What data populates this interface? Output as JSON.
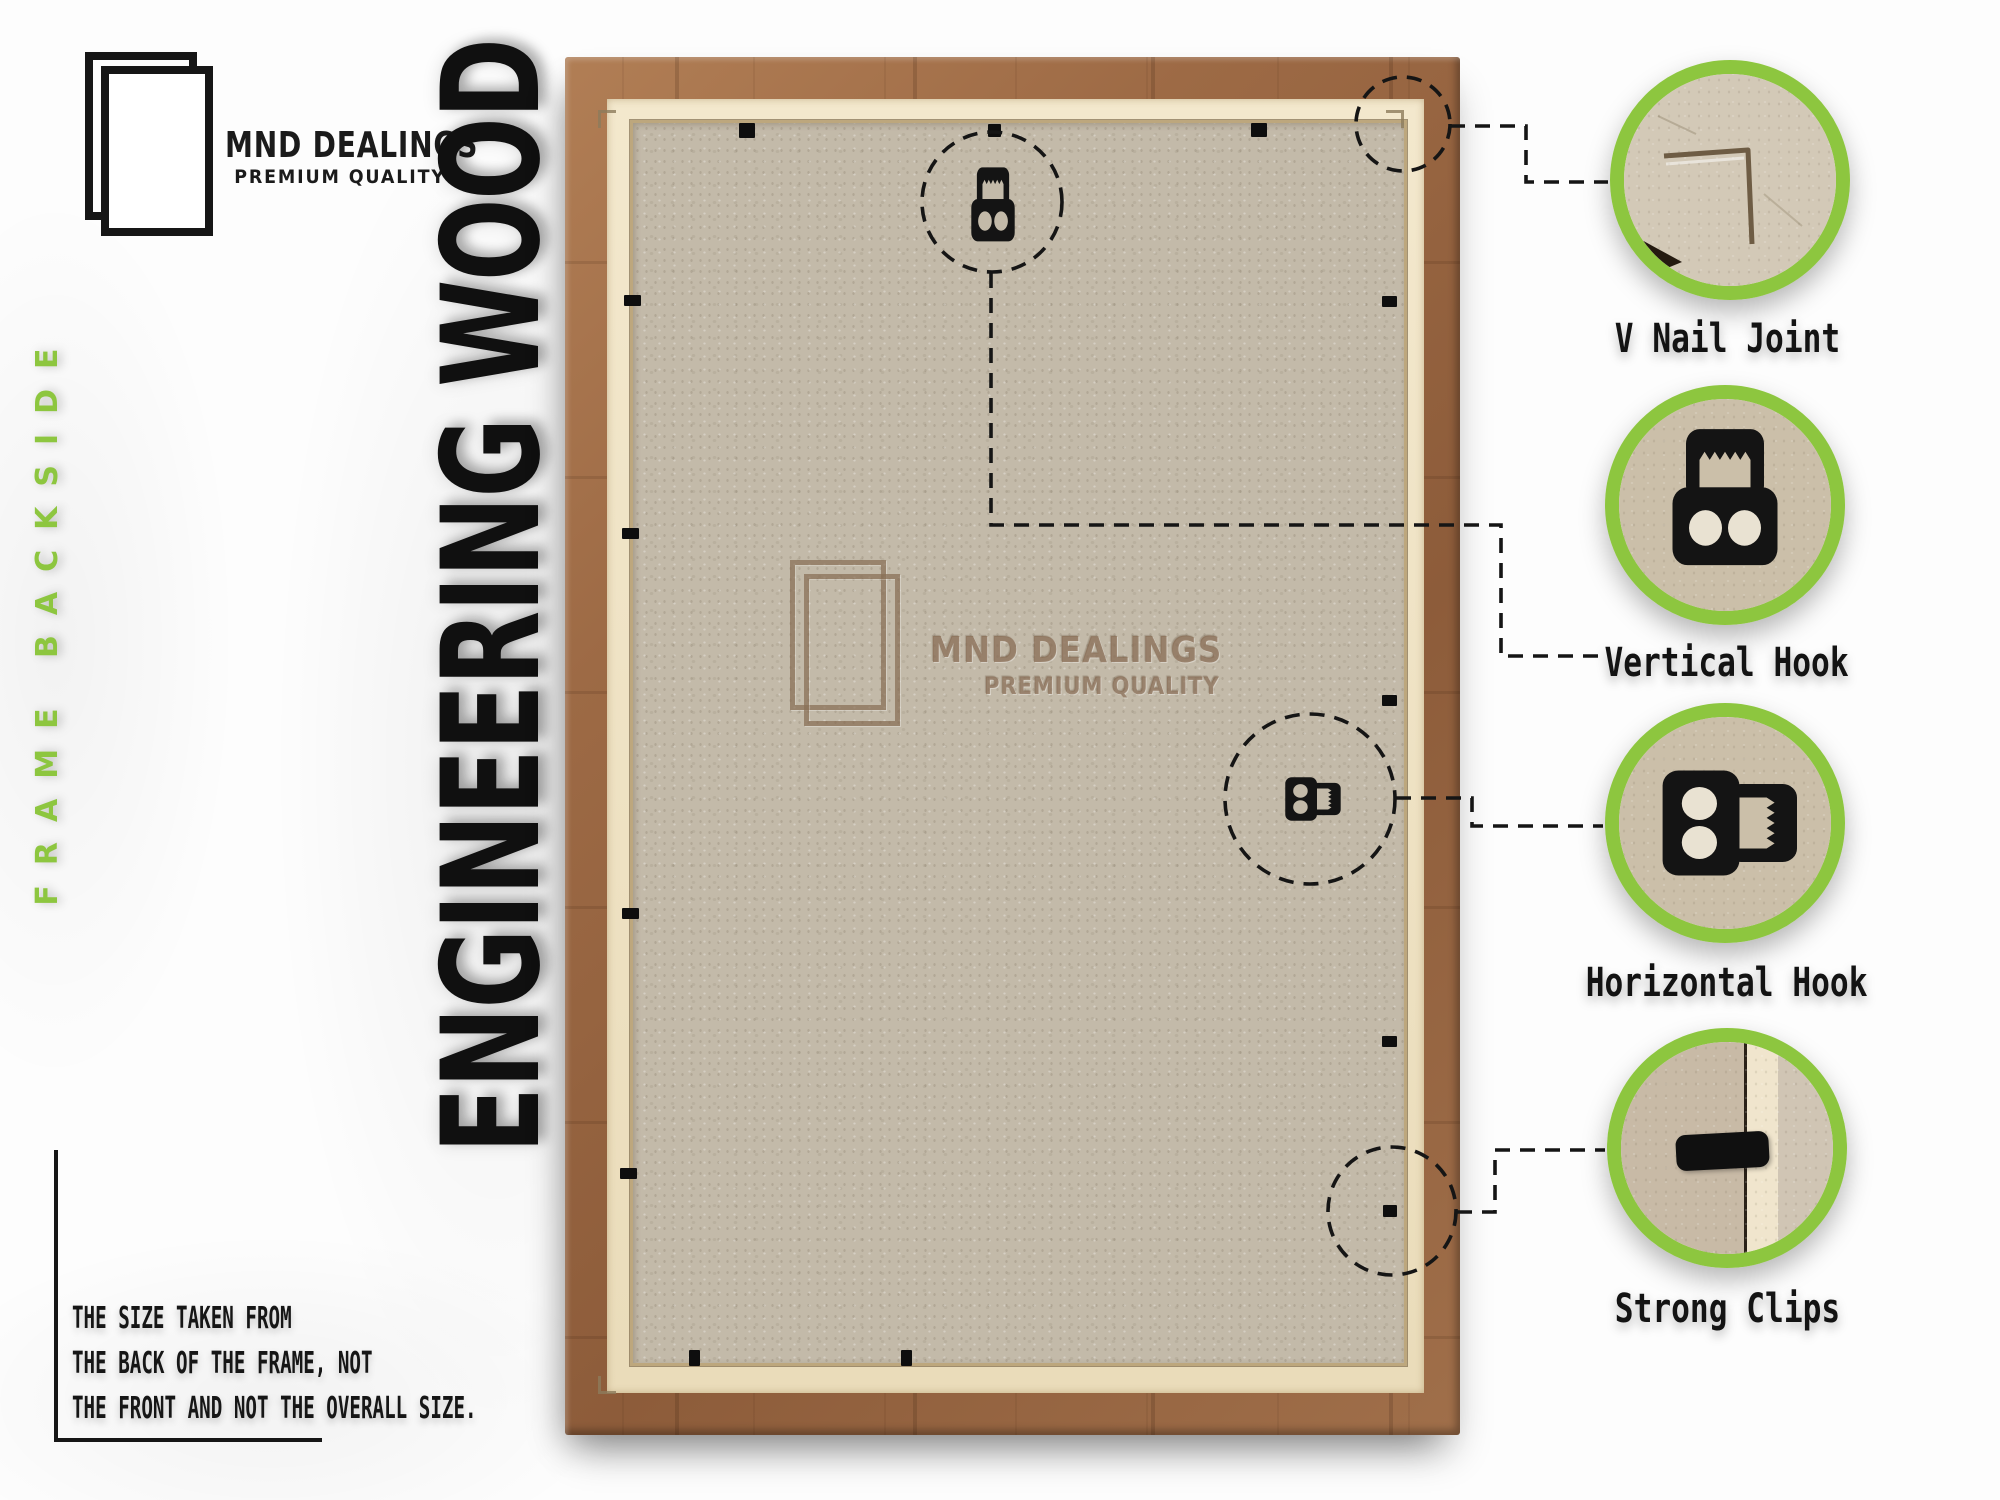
{
  "brand": {
    "name": "MND DEALINGS",
    "tagline": "PREMIUM QUALITY"
  },
  "side_label": "FRAME BACKSIDE",
  "material_label": "ENGINEERING WOOD",
  "watermark": {
    "name": "MND DEALINGS",
    "tagline": "PREMIUM QUALITY"
  },
  "callouts": [
    {
      "id": "v-nail-joint",
      "label": "V Nail Joint"
    },
    {
      "id": "vertical-hook",
      "label": "Vertical Hook"
    },
    {
      "id": "horizontal-hook",
      "label": "Horizontal Hook"
    },
    {
      "id": "strong-clips",
      "label": "Strong Clips"
    }
  ],
  "footnote": {
    "lines": [
      "THE SIZE TAKEN FROM",
      "THE BACK OF THE FRAME, NOT",
      "THE FRONT AND NOT THE OVERALL SIZE."
    ]
  },
  "icons": {
    "brand_logo": "overlapping-frames-icon",
    "watermark_logo": "overlapping-frames-icon",
    "hook_top": "vertical-hook-icon",
    "hook_right": "horizontal-hook-icon"
  },
  "colors": {
    "accent_green": "#8DC63F",
    "wood_brown": "#9B6A47",
    "cream": "#EFE2C6",
    "board_tan": "#C2B9A8",
    "ink_black": "#141414"
  }
}
